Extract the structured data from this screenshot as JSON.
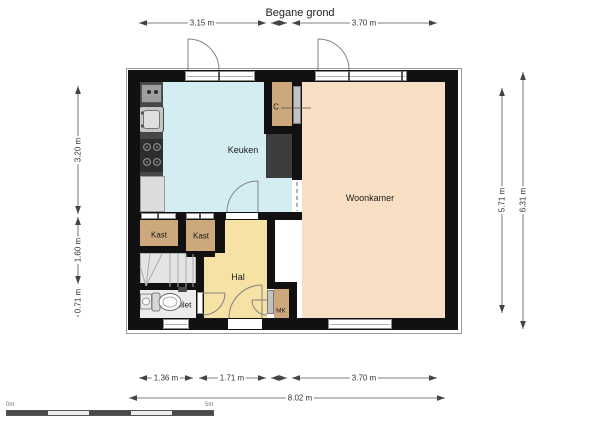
{
  "title": "Begane grond",
  "rooms": {
    "kitchen": "Keuken",
    "living": "Woonkamer",
    "hall": "Hal",
    "closet1": "Kast",
    "closet2": "Kast",
    "closet_c": "C",
    "toilet": "Toilet",
    "meter_closet": "MK"
  },
  "dimensions": {
    "top": [
      "3.15 m",
      "3.70 m"
    ],
    "left": [
      "3.20 m",
      "1.60 m",
      "0.71 m"
    ],
    "right": [
      "5.71 m",
      "6.31 m"
    ],
    "bottom": [
      "1.36 m",
      "1.71 m",
      "3.70 m"
    ],
    "bottom_total": "8.02 m"
  },
  "scale_bar": {
    "start_label": "0m",
    "end_label": "5m"
  },
  "colors": {
    "wall": "#111111",
    "kitchen": "#d3edf2",
    "living": "#f8dfc3",
    "hall": "#f5e2a4",
    "closet": "#cda87d",
    "stairs": "#e4e4e4",
    "toilet_floor": "#ececec",
    "appliance_dark": "#3d3d3d"
  }
}
